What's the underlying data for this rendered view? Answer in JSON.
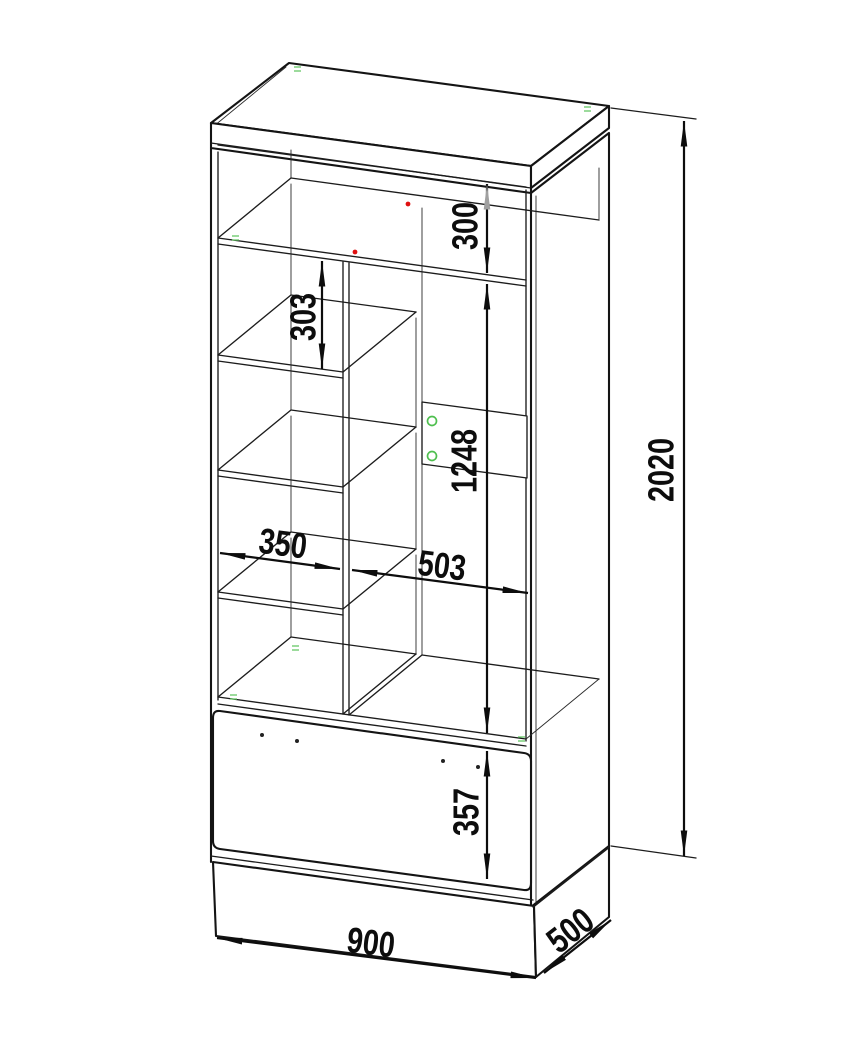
{
  "drawing": {
    "kind": "isometric furniture dimension drawing",
    "object": "wardrobe cabinet with shelves and bottom drawer",
    "background_color": "#ffffff",
    "line_color": "#141414",
    "marker_colors": {
      "hole_marker_green": "#4fbf4f",
      "dowel_dot_red": "#e01010",
      "highlight_arrow_gray": "#a0a0a0"
    },
    "dimensions": {
      "overall_height": "2020",
      "overall_width": "900",
      "overall_depth": "500",
      "top_compartment_height": "300",
      "left_shelf_gap": "303",
      "right_compartment_height": "1248",
      "left_column_width": "350",
      "right_compartment_width": "503",
      "drawer_front_height": "357"
    }
  }
}
